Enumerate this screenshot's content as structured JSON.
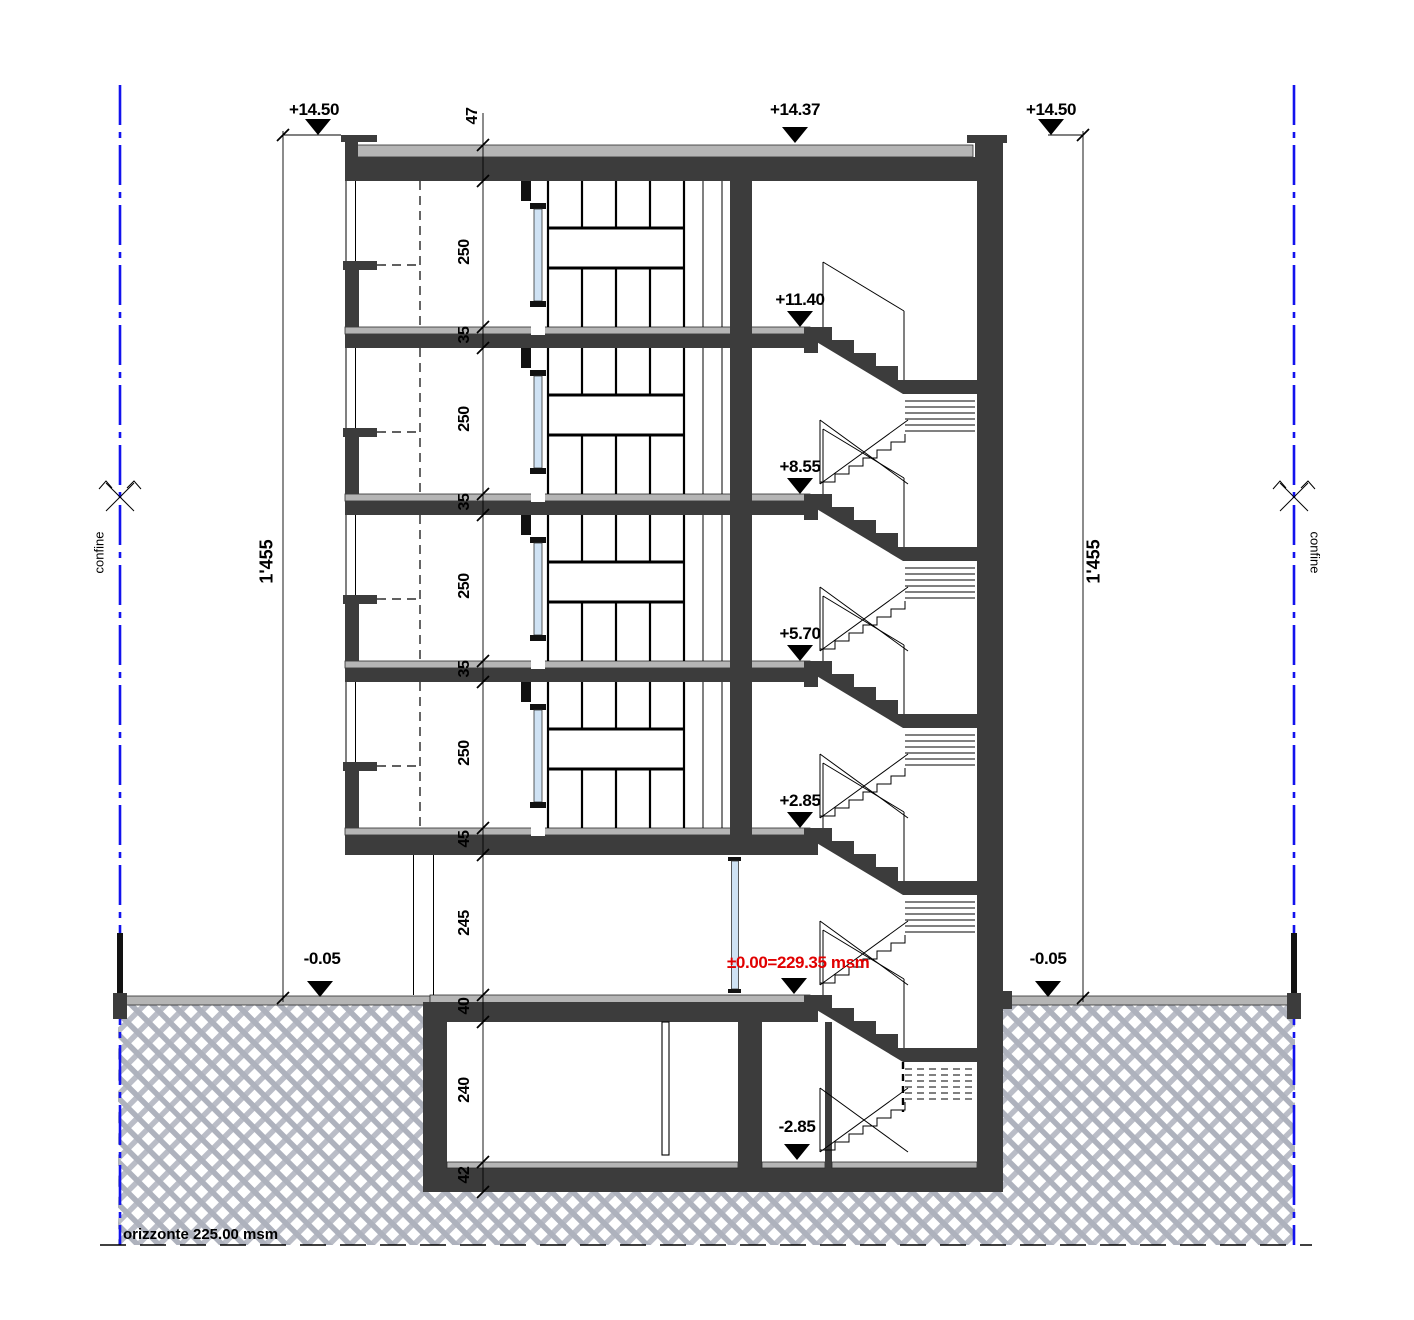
{
  "levels": {
    "roof_parapet_left": "+14.50",
    "roof_top": "+14.37",
    "roof_parapet_right": "+14.50",
    "floor_4": "+11.40",
    "floor_3": "+8.55",
    "floor_2": "+5.70",
    "floor_1": "+2.85",
    "ground_datum": "±0.00=229.35 msm",
    "grade_left": "-0.05",
    "grade_right": "-0.05",
    "basement": "-2.85"
  },
  "dimensions": {
    "chain": [
      "47",
      "250",
      "35",
      "250",
      "35",
      "250",
      "35",
      "250",
      "45",
      "245",
      "40",
      "240",
      "42"
    ],
    "total_left": "1'455",
    "total_right": "1'455"
  },
  "site": {
    "boundary_left": "confine",
    "boundary_right": "confine",
    "horizon": "orizzonte 225.00 msm"
  },
  "colors": {
    "structure": "#3c3c3c",
    "screed": "#b5b5b5",
    "glass": "#cfe2f4",
    "datum_text": "#e10000",
    "boundary_line": "#1212ee",
    "earth_hatch": "#aeb2bd"
  }
}
